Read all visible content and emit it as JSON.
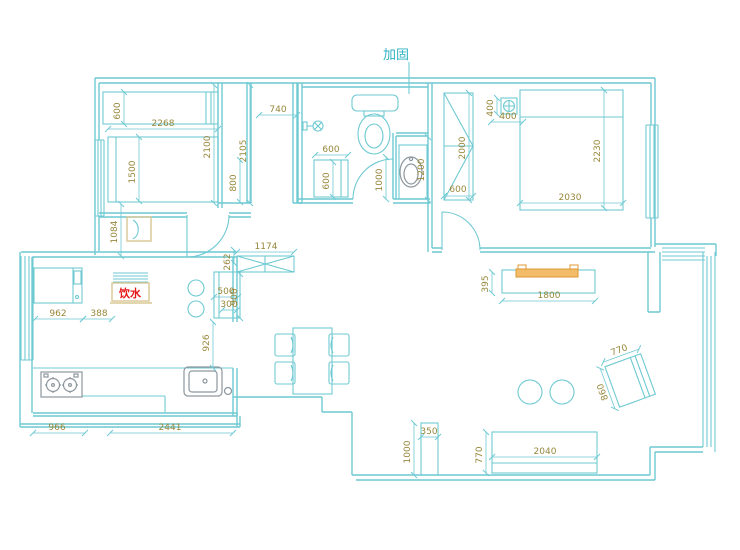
{
  "notes": {
    "reinforce": "加固",
    "water": "饮水"
  },
  "colors": {
    "line": "#6ec9d2",
    "dim": "#97873b",
    "teal": "#2fb2c2",
    "red": "#e51717",
    "tan": "#d8c894",
    "orange": "#dd9a33",
    "orangef": "#f2bc6a",
    "gray": "#8d979d",
    "bg": "#ffffff"
  },
  "dims": {
    "wardrobe1_depth": "600",
    "bed1_width": "2268",
    "bed1_length": "1500",
    "bedroom1_length": "2100",
    "closet_length": "2105",
    "closet_lower": "800",
    "closet_width": "740",
    "side_table_run": "1084",
    "bath_cabinet_width": "600",
    "bath_cabinet_depth": "600",
    "vanity_length": "1000",
    "vanity_depth": "1200",
    "nightstand_depth": "400",
    "nightstand_width": "400",
    "wardrobe2_length": "2000",
    "wardrobe2_depth": "600",
    "bed2_length": "2230",
    "bed2_width": "2030",
    "entry_gap": "262",
    "shoe_cabinet": "1174",
    "kitchen_cabinet_width": "500",
    "kitchen_cabinet_inner": "300",
    "kitchen_cabinet_length": "900",
    "kitchen_passage": "926",
    "fridge_width": "962",
    "fridge_gap": "388",
    "counter_left": "966",
    "counter_main": "2441",
    "tv_depth": "395",
    "tv_width": "1800",
    "armchair_width": "770",
    "armchair_depth": "860",
    "cabinet_width": "350",
    "cabinet_length": "1000",
    "sofa_depth": "770",
    "sofa_width": "2040"
  }
}
